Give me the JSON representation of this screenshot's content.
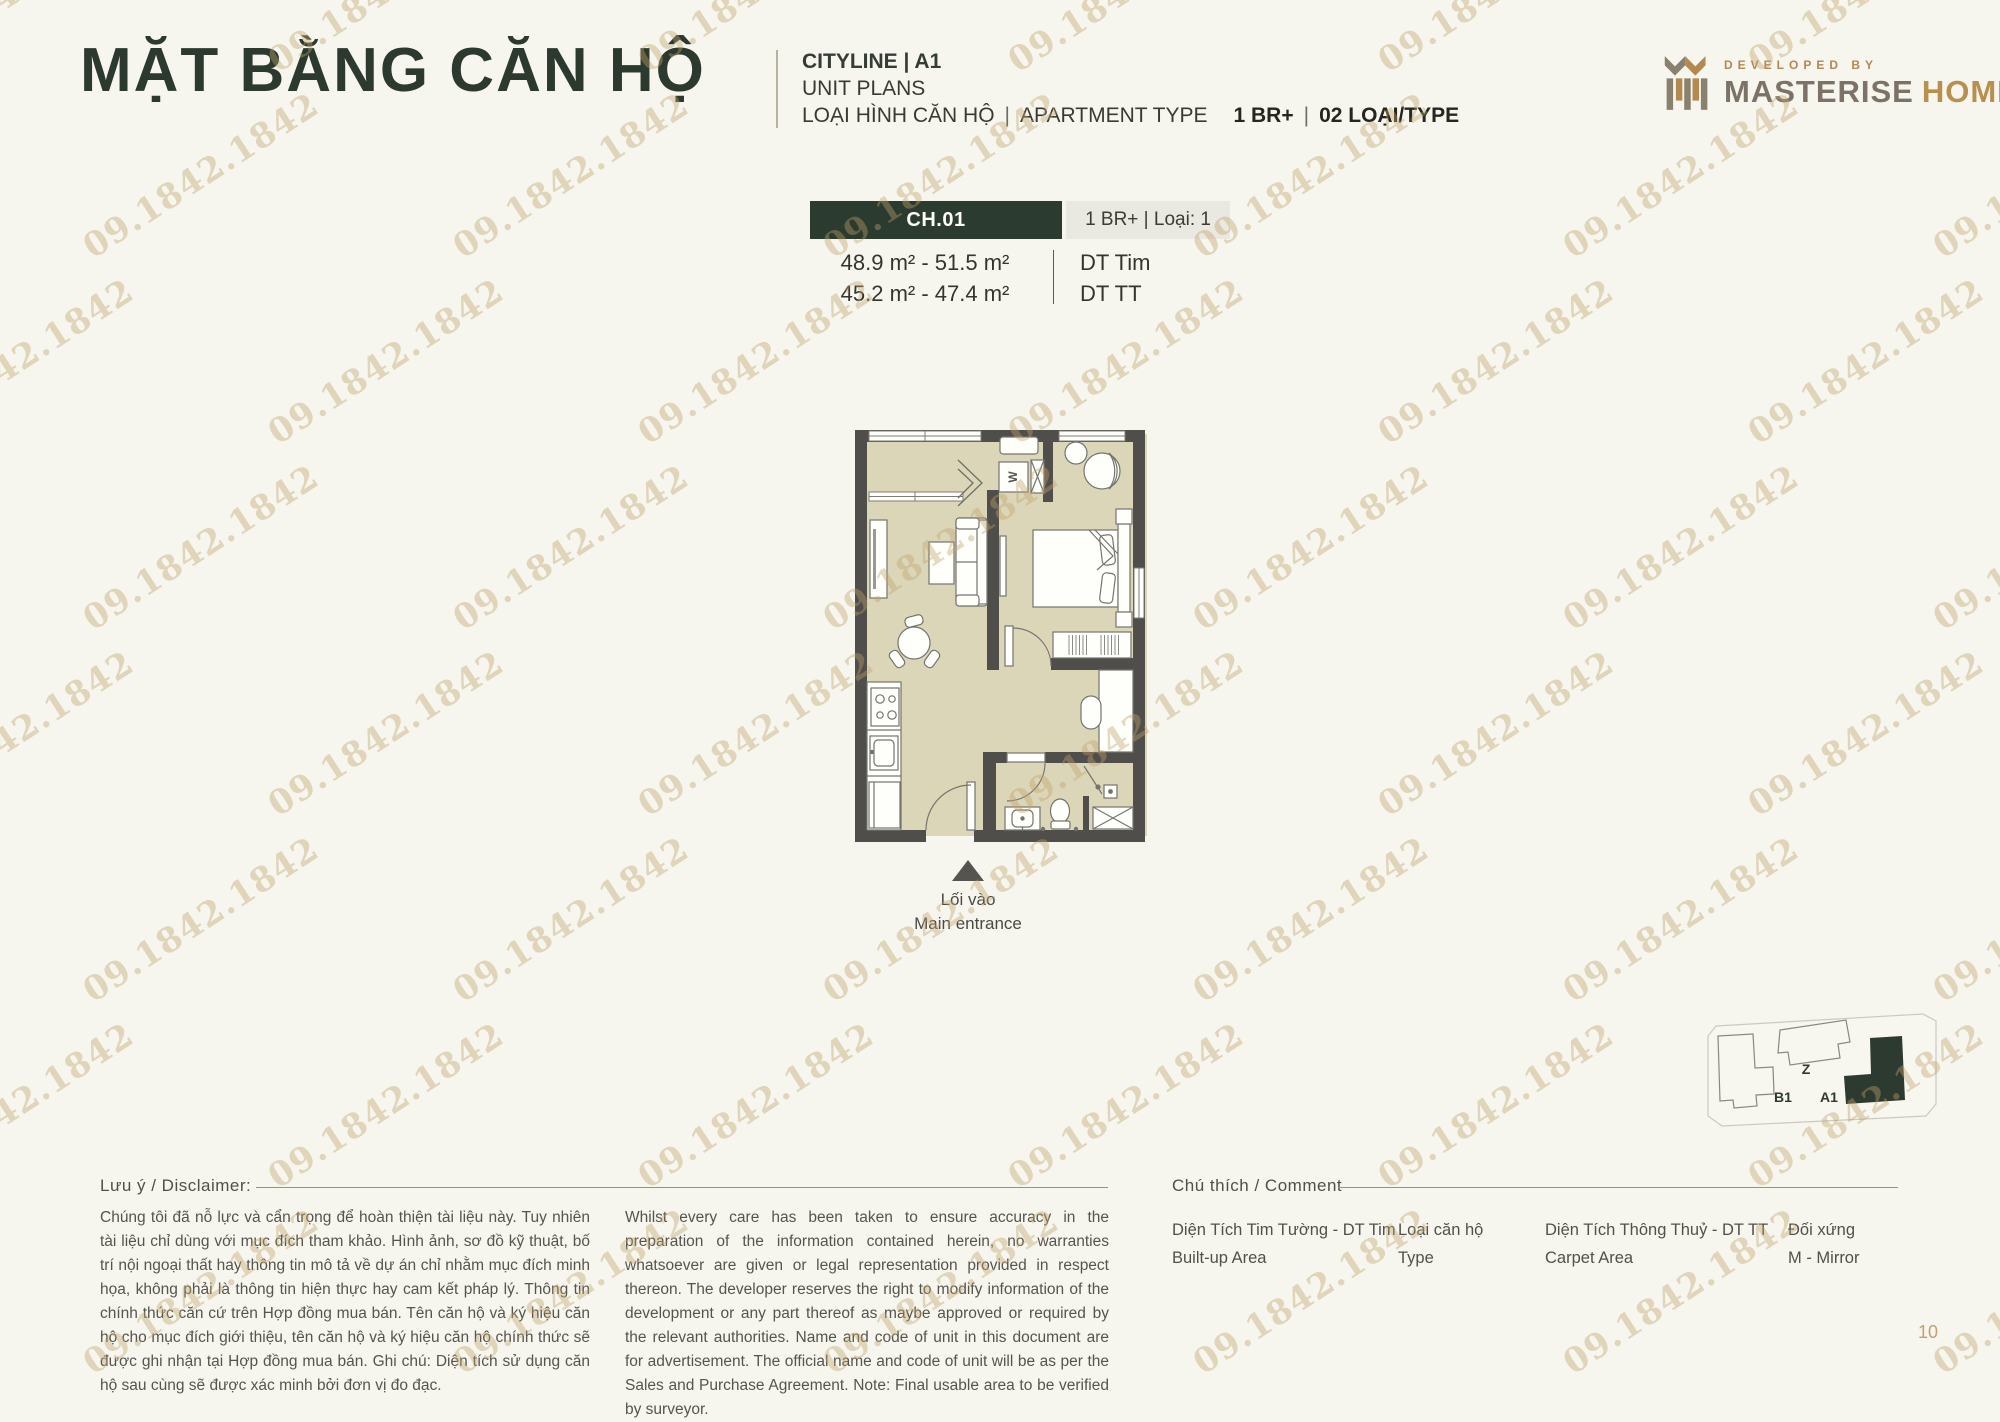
{
  "watermark": {
    "text": "09.1842.1842"
  },
  "header": {
    "title": "MẶT BẰNG CĂN HỘ",
    "project": "CITYLINE | A1",
    "subtitle": "UNIT PLANS",
    "type_label_vn": "LOẠI HÌNH CĂN HỘ",
    "type_label_en": "APARTMENT TYPE",
    "type_value": "1 BR+",
    "type_count": "02 LOẠI/TYPE",
    "pipe": "|"
  },
  "logo": {
    "developed_by": "DEVELOPED BY",
    "brand_1": "MASTERISE",
    "brand_2": "HOMES"
  },
  "unit_card": {
    "code": "CH.01",
    "type_info": "1 BR+ | Loại: 1",
    "rows": [
      {
        "area": "48.9 m² - 51.5 m²",
        "label": "DT Tim"
      },
      {
        "area": "45.2 m² - 47.4 m²",
        "label": "DT TT"
      }
    ]
  },
  "floor_plan": {
    "washer_label": "W",
    "entrance_label_vn": "Lối vào",
    "entrance_label_en": "Main entrance"
  },
  "site_map": {
    "building_z": "Z",
    "building_b1": "B1",
    "building_a1": "A1"
  },
  "footer": {
    "disclaimer_heading": "Lưu ý / Disclaimer:",
    "disclaimer_vn": "Chúng tôi đã nỗ lực và cẩn trọng để hoàn thiện tài liệu này. Tuy nhiên tài liệu chỉ dùng với mục đích tham khảo. Hình ảnh, sơ đồ kỹ thuật, bố trí nội ngoại thất hay thông tin mô tả về dự án chỉ nhằm mục đích minh họa, không phải là thông tin hiện thực hay cam kết pháp lý. Thông tin chính thức căn cứ trên Hợp đồng mua bán. Tên căn hộ và ký hiệu căn hộ cho mục đích giới thiệu, tên căn hộ và ký hiệu căn hộ chính thức sẽ được ghi nhận tại Hợp đồng mua bán. Ghi chú: Diện tích sử dụng căn hộ sau cùng sẽ được xác minh bởi đơn vị đo đạc.",
    "disclaimer_en": "Whilst every care has been taken to ensure accuracy in the preparation of the information contained herein, no warranties whatsoever are given or legal representation provided in respect thereon. The developer reserves the right to modify information of the development or any part thereof as maybe approved or required by the relevant authorities. Name and code of unit in this document are for advertisement. The official name and code of unit will be as per the Sales and Purchase Agreement. Note: Final usable area to be verified by surveyor.",
    "legend_heading": "Chú thích / Comment",
    "legend": [
      {
        "vn": "Diện Tích Tim Tường - DT Tim",
        "en": "Built-up Area"
      },
      {
        "vn": "Loại căn hộ",
        "en": "Type"
      },
      {
        "vn": "Diện Tích Thông Thuỷ - DT TT",
        "en": "Carpet Area"
      },
      {
        "vn": "Đối xứng",
        "en": "M - Mirror"
      }
    ],
    "page_number": "10"
  },
  "colors": {
    "accent_green": "#2c3b2f",
    "gold": "#b98f4e",
    "watermark_gold": "#c1a26a",
    "wall_gray": "#504e4b",
    "floor_beige": "#dcd6b8"
  }
}
